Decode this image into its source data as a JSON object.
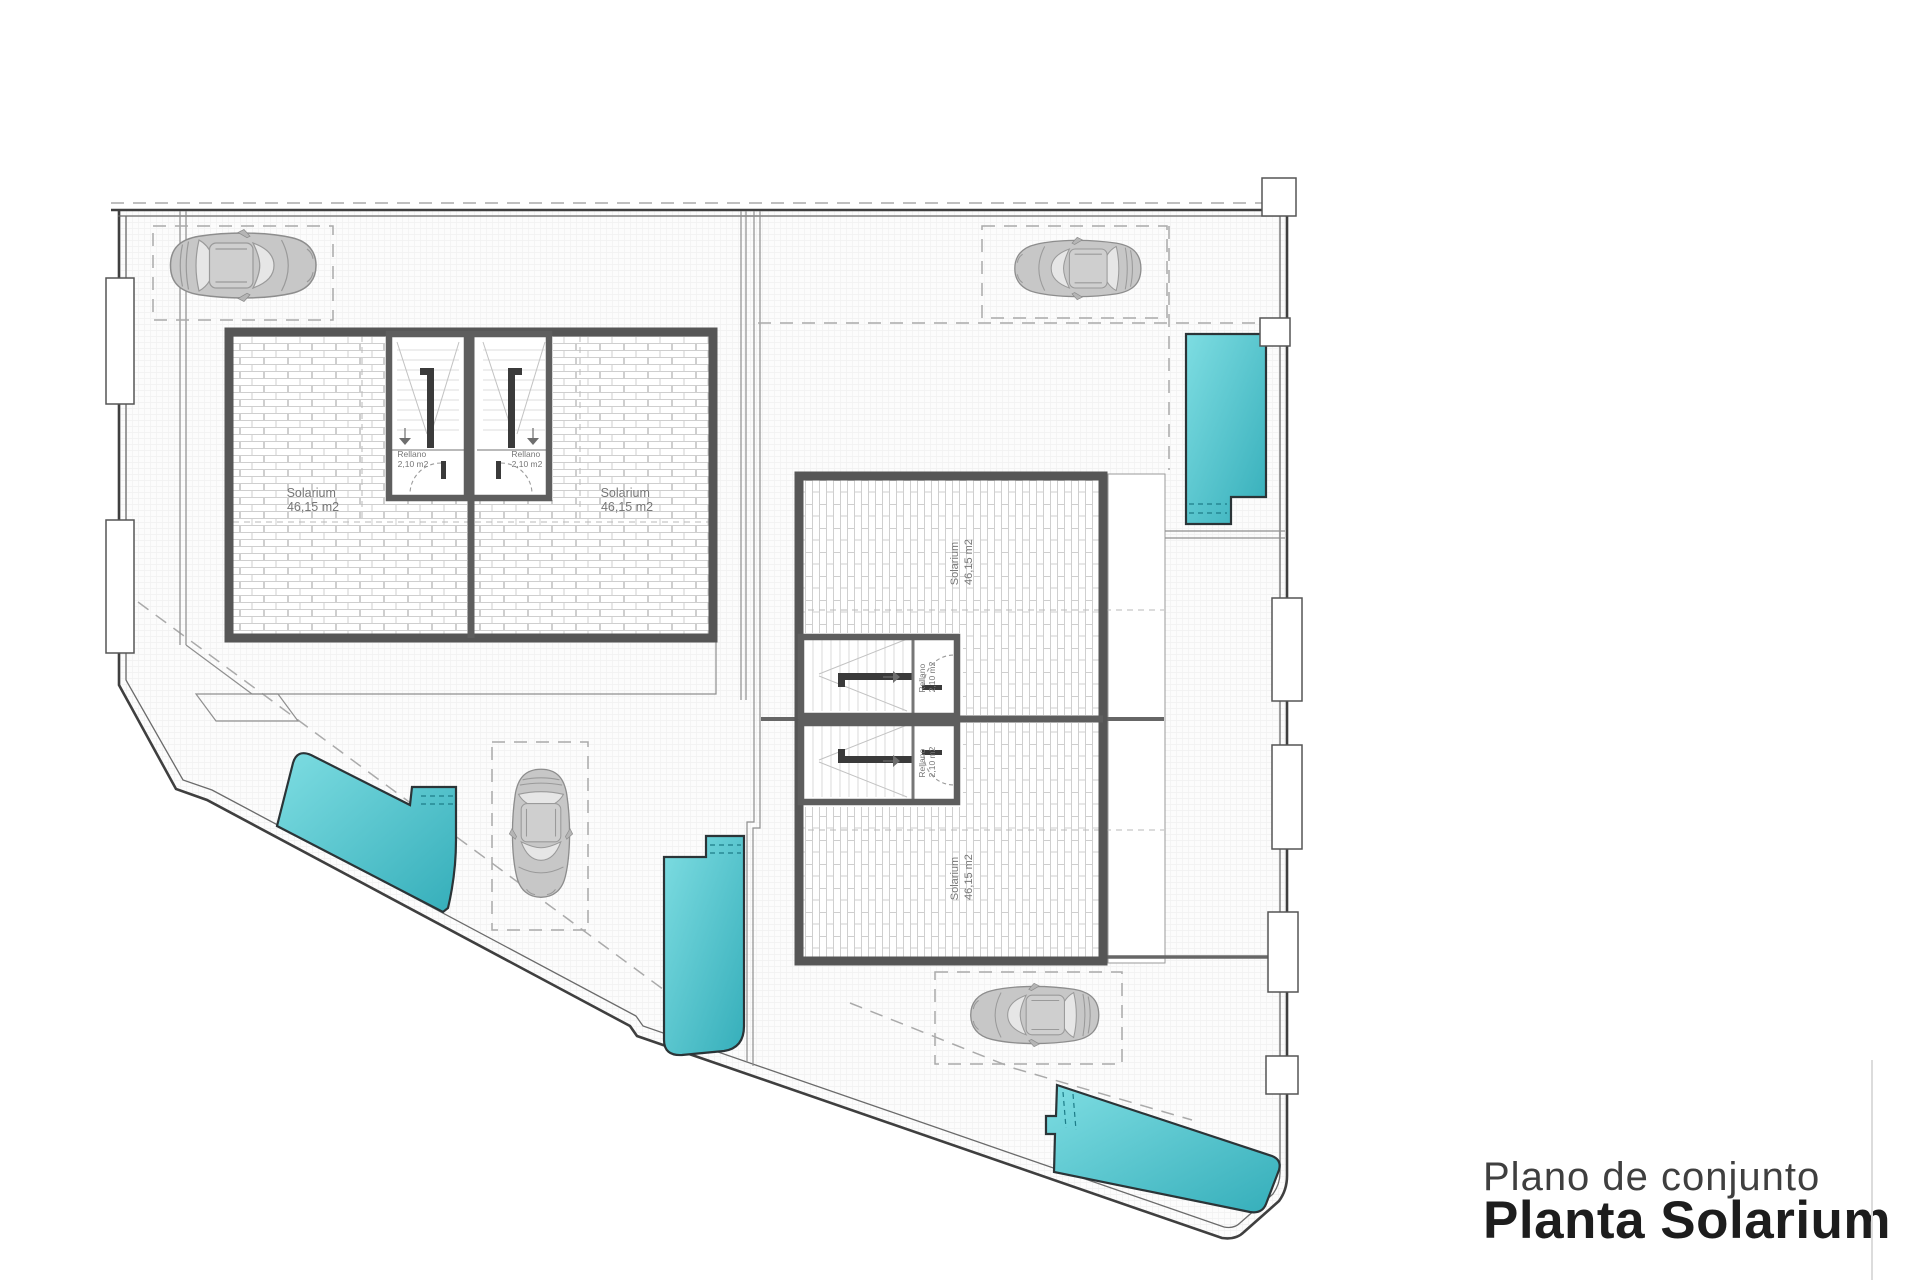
{
  "title_block": {
    "subtitle": "Plano de conjunto",
    "title": "Planta Solarium"
  },
  "labels": {
    "solarium_name": "Solarium",
    "solarium_area": "46,15 m2",
    "rellano_name": "Rellano",
    "rellano_area": "2,10 m2"
  },
  "site": {
    "buildings": 2,
    "units": 4,
    "stair_cores": 4,
    "cars_parked": 4,
    "parking_spaces": 4,
    "pools": 4
  },
  "colors": {
    "pool": "#35aeba",
    "pool_light": "#7edde2",
    "wall": "#565656",
    "hatch": "#cfcfcf",
    "dash": "#aaaaaa",
    "text": "#777777",
    "title_text": "#1d1d1d",
    "subtitle_text": "#3f3f3f"
  }
}
